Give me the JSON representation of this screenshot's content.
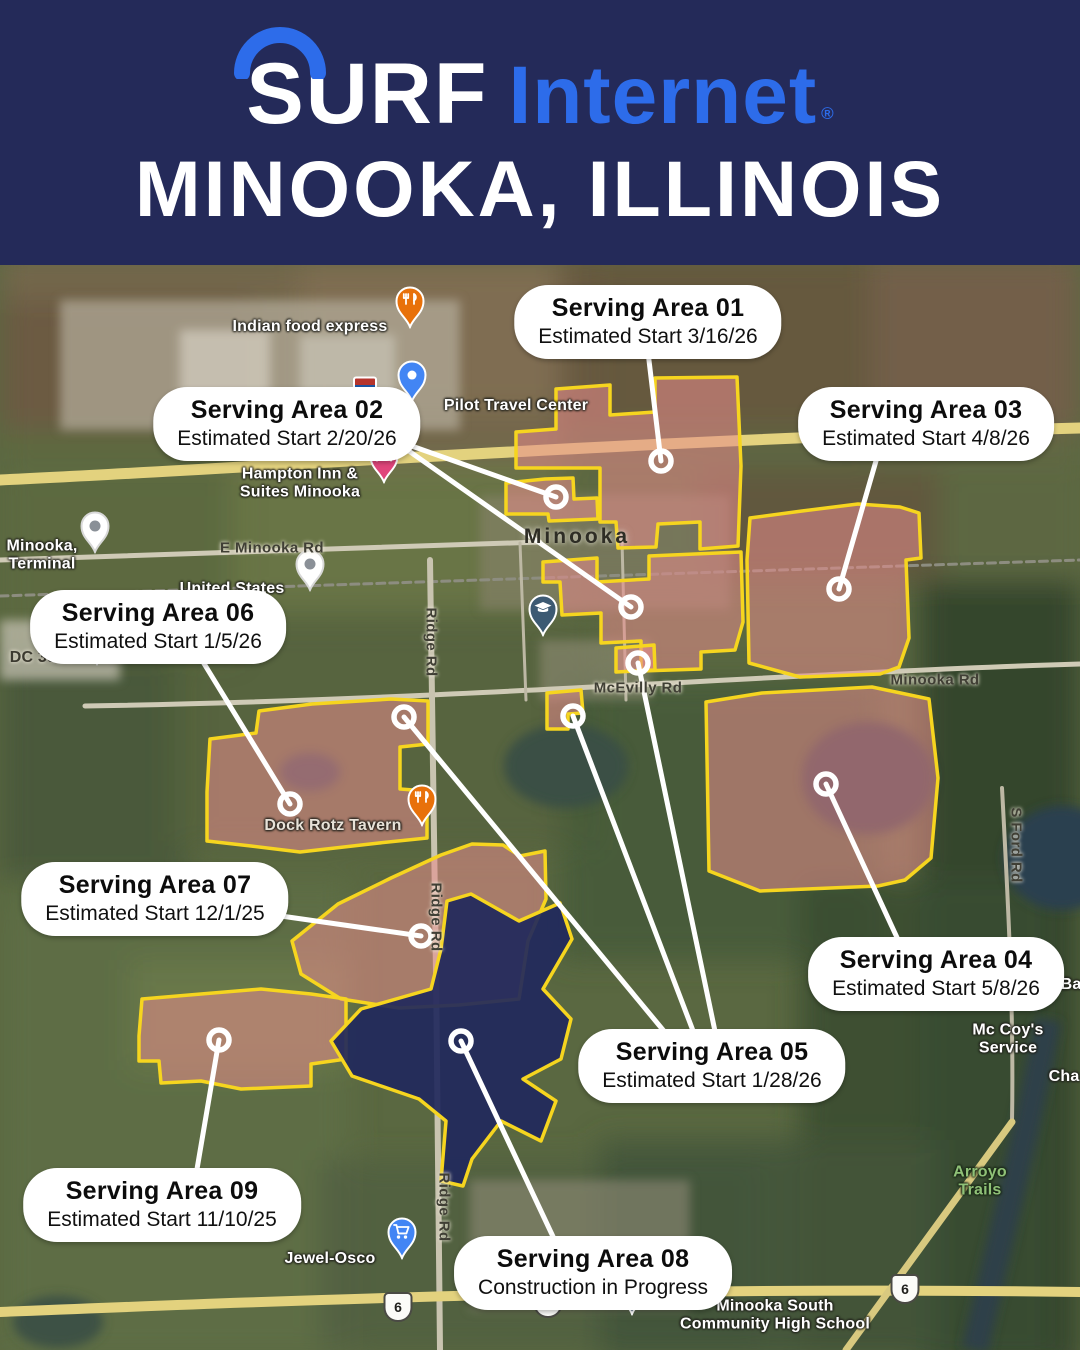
{
  "header": {
    "brand_surf": "SURF",
    "brand_internet": "Internet",
    "registered_mark": "®",
    "location_title": "MINOOKA, ILLINOIS"
  },
  "colors": {
    "header_bg": "#242a59",
    "brand_blue": "#2d6cea",
    "area_fill_pink": "rgba(231,140,140,0.55)",
    "area_fill_navy": "rgba(33,40,92,0.92)",
    "area_stroke_yellow": "#f6d51f",
    "leader_white": "#ffffff"
  },
  "serving_areas": [
    {
      "name": "Serving Area 01",
      "status": "Estimated Start 3/16/26",
      "pill": {
        "cx": 648,
        "cy": 322
      },
      "leaders": [
        [
          648,
          352,
          661,
          461
        ]
      ]
    },
    {
      "name": "Serving Area 02",
      "status": "Estimated Start 2/20/26",
      "pill": {
        "cx": 287,
        "cy": 424
      },
      "leaders": [
        [
          406,
          444,
          556,
          497
        ],
        [
          406,
          449,
          631,
          607
        ]
      ]
    },
    {
      "name": "Serving Area 03",
      "status": "Estimated Start 4/8/26",
      "pill": {
        "cx": 926,
        "cy": 424
      },
      "leaders": [
        [
          878,
          454,
          839,
          589
        ]
      ]
    },
    {
      "name": "Serving Area 06",
      "status": "Estimated Start 1/5/26",
      "pill": {
        "cx": 158,
        "cy": 627
      },
      "leaders": [
        [
          200,
          657,
          290,
          804
        ]
      ]
    },
    {
      "name": "Serving Area 07",
      "status": "Estimated Start 12/1/25",
      "pill": {
        "cx": 155,
        "cy": 899
      },
      "leaders": [
        [
          274,
          915,
          421,
          936
        ]
      ]
    },
    {
      "name": "Serving Area 04",
      "status": "Estimated Start 5/8/26",
      "pill": {
        "cx": 936,
        "cy": 974
      },
      "leaders": [
        [
          900,
          944,
          826,
          784
        ]
      ]
    },
    {
      "name": "Serving Area 05",
      "status": "Estimated Start 1/28/26",
      "pill": {
        "cx": 712,
        "cy": 1066
      },
      "leaders": [
        [
          668,
          1036,
          404,
          717
        ],
        [
          695,
          1036,
          573,
          716
        ],
        [
          716,
          1036,
          638,
          663
        ]
      ]
    },
    {
      "name": "Serving Area 09",
      "status": "Estimated Start 11/10/25",
      "pill": {
        "cx": 162,
        "cy": 1205
      },
      "leaders": [
        [
          196,
          1175,
          219,
          1040
        ]
      ]
    },
    {
      "name": "Serving Area 08",
      "status": "Construction in Progress",
      "pill": {
        "cx": 593,
        "cy": 1273
      },
      "leaders": [
        [
          556,
          1243,
          461,
          1041
        ]
      ]
    }
  ],
  "map": {
    "polygons": [
      {
        "area": "01",
        "type": "pink",
        "path": "M516,468 L516,432 L556,429 L556,389 L610,385 L610,415 L655,412 L655,378 L737,377 L741,466 L738,546 L700,549 L700,522 L658,524 L656,547 L618,548 L616,522 L600,522 L600,468 Z"
      },
      {
        "area": "02",
        "type": "pink",
        "path": "M506,514 L506,483 L545,479 L573,478 L574,499 L597,498 L598,519 L549,521 L548,514 Z"
      },
      {
        "area": "01-south",
        "type": "pink",
        "path": "M543,562 L597,558 L597,582 L649,579 L649,556 L741,552 L743,622 L735,650 L701,652 L701,669 L641,671 L641,641 L601,643 L601,613 L562,615 L560,582 L543,582 Z"
      },
      {
        "area": "05-a",
        "type": "pink",
        "path": "M547,729 L547,693 L581,690 L583,713 L568,714 L568,729 Z"
      },
      {
        "area": "05-b",
        "type": "pink",
        "path": "M616,672 L616,648 L654,645 L655,670 Z"
      },
      {
        "area": "03",
        "type": "pink",
        "path": "M747,560 L750,518 L802,511 L858,504 L900,507 L919,513 L921,558 L906,560 L909,638 L899,667 L880,674 L800,677 L749,663 Z"
      },
      {
        "area": "04",
        "type": "pink",
        "path": "M706,702 L762,693 L872,687 L929,699 L938,778 L931,858 L905,880 L878,886 L760,891 L709,871 Z"
      },
      {
        "area": "06",
        "type": "pink",
        "path": "M207,792 L210,739 L256,733 L259,711 L312,704 L391,699 L428,701 L428,744 L400,747 L400,789 L427,791 L427,838 L379,843 L300,852 L251,846 L207,841 Z"
      },
      {
        "area": "07",
        "type": "pink",
        "path": "M292,941 L338,904 L391,878 L441,855 L472,844 L503,845 L520,856 L545,851 L546,899 L528,941 L519,999 L459,1005 L399,1008 L341,999 L301,974 Z"
      },
      {
        "area": "09",
        "type": "pink",
        "path": "M139,1036 L142,999 L201,994 L261,989 L311,994 L346,999 L346,1059 L311,1064 L311,1086 L241,1089 L201,1081 L161,1083 L159,1061 L139,1061 Z"
      },
      {
        "area": "08",
        "type": "navy",
        "path": "M447,901 L471,894 L519,921 L560,903 L572,939 L543,989 L571,1019 L561,1059 L523,1079 L556,1101 L541,1141 L501,1121 L472,1159 L463,1186 L441,1181 L446,1121 L419,1099 L352,1076 L331,1041 L361,1009 L431,989 L441,949 Z"
      }
    ],
    "pois": [
      {
        "id": "indian-food-express",
        "label": "Indian food express",
        "x": 310,
        "y": 327,
        "style": "white",
        "pin": {
          "icon": "restaurant",
          "x": 410,
          "y": 325,
          "color": "#e8710a"
        }
      },
      {
        "id": "pilot-travel-center",
        "label": "Pilot Travel Center",
        "x": 516,
        "y": 406,
        "style": "white",
        "pin": {
          "icon": "dot-blue",
          "x": 412,
          "y": 399,
          "color": "#4285f4"
        }
      },
      {
        "id": "hampton-inn-suites",
        "label": "Hampton Inn &\nSuites Minooka",
        "x": 300,
        "y": 484,
        "style": "white",
        "pin": {
          "icon": "hotel",
          "x": 384,
          "y": 480,
          "color": "#e0457b"
        }
      },
      {
        "id": "minooka-terminal",
        "label": "Minooka,\nTerminal",
        "x": 42,
        "y": 556,
        "style": "white",
        "pin": {
          "icon": "dot-gray",
          "x": 95,
          "y": 550,
          "color": "#ffffff"
        }
      },
      {
        "id": "united-states",
        "label": "United States",
        "x": 232,
        "y": 589,
        "style": "white",
        "pin": {
          "icon": "dot-gray",
          "x": 310,
          "y": 588,
          "color": "#ffffff"
        }
      },
      {
        "id": "dc-3950",
        "label": "DC 3950",
        "x": 42,
        "y": 658,
        "style": "dark",
        "pin": {
          "icon": "dot-gray",
          "x": 97,
          "y": 662,
          "color": "#ffffff"
        }
      },
      {
        "id": "minooka-town",
        "label": "Minooka",
        "x": 577,
        "y": 537,
        "style": "town"
      },
      {
        "id": "dock-rotz-tavern",
        "label": "Dock Rotz Tavern",
        "x": 333,
        "y": 826,
        "style": "muted",
        "pin": {
          "icon": "restaurant",
          "x": 422,
          "y": 823,
          "color": "#e8710a"
        }
      },
      {
        "id": "mccoys-service",
        "label": "Mc Coy's Service",
        "x": 1008,
        "y": 1040,
        "style": "white"
      },
      {
        "id": "channahon-partial",
        "label": "Cha",
        "x": 1064,
        "y": 1077,
        "style": "white"
      },
      {
        "id": "ba-partial",
        "label": "Ba",
        "x": 1071,
        "y": 985,
        "style": "white"
      },
      {
        "id": "arroyo-trails",
        "label": "Arroyo Trails",
        "x": 980,
        "y": 1182,
        "style": "park"
      },
      {
        "id": "jewel-osco",
        "label": "Jewel-Osco",
        "x": 330,
        "y": 1259,
        "style": "white",
        "pin": {
          "icon": "cart",
          "x": 402,
          "y": 1256,
          "color": "#4285f4"
        }
      },
      {
        "id": "minooka-south-high-school",
        "label": "Minooka South\nCommunity High School",
        "x": 775,
        "y": 1316,
        "style": "white",
        "pin": {
          "icon": "school",
          "x": 632,
          "y": 1312,
          "color": "#3d5a73"
        }
      },
      {
        "id": "minooka-school",
        "label": "",
        "x": 543,
        "y": 633,
        "style": "white",
        "pin": {
          "icon": "school",
          "x": 543,
          "y": 633,
          "color": "#3d5a73"
        }
      }
    ],
    "road_labels": [
      {
        "text": "E Minooka Rd",
        "x": 272,
        "y": 548,
        "vertical": false
      },
      {
        "text": "McEvilly Rd",
        "x": 638,
        "y": 688,
        "vertical": false
      },
      {
        "text": "Minooka Rd",
        "x": 935,
        "y": 680,
        "vertical": false
      },
      {
        "text": "S Ford Rd",
        "x": 1016,
        "y": 845,
        "vertical": true
      },
      {
        "text": "Ridge Rd",
        "x": 431,
        "y": 642,
        "vertical": true
      },
      {
        "text": "Ridge Rd",
        "x": 436,
        "y": 917,
        "vertical": true
      },
      {
        "text": "Ridge Rd",
        "x": 444,
        "y": 1207,
        "vertical": true
      }
    ],
    "route_shields": [
      {
        "label": "6",
        "x": 398,
        "y": 1307
      },
      {
        "label": "6",
        "x": 548,
        "y": 1303
      },
      {
        "label": "6",
        "x": 905,
        "y": 1289
      }
    ],
    "interstate_shield": {
      "label": "80",
      "x": 365,
      "y": 389
    }
  }
}
